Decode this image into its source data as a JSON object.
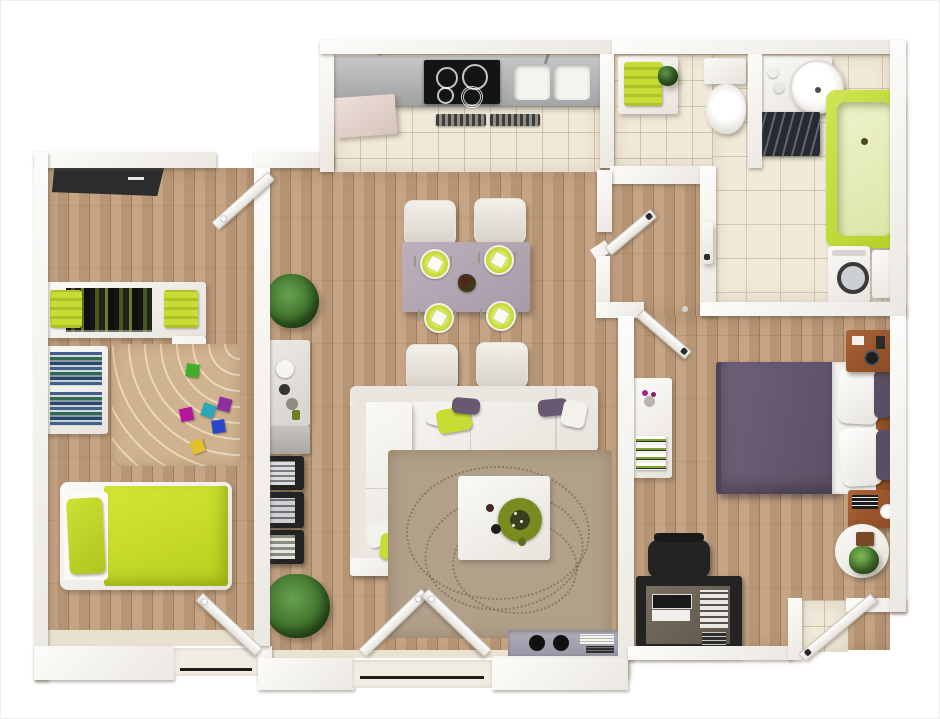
{
  "scene": {
    "type": "3d-floor-plan-top-view",
    "subject": "two-bedroom apartment rendered from above with lime green and purple accents",
    "background": "#ffffff"
  },
  "palette": {
    "wall": "#f7f5f2",
    "wall_shade": "#d8d2c9",
    "wood": "#c19e7c",
    "wood_line": "#a07c57",
    "tile": "#f0e9d9",
    "tile_line": "#cbbda0",
    "lime": "#c6dd33",
    "lime_dark": "#a9c11c",
    "lime_pale": "#e9efc0",
    "purple": "#685970",
    "purple_dark": "#564b60",
    "mauve": "#b3a6b3",
    "taupe_rug": "#b2a08a",
    "beige_rug": "#cfb28e",
    "dark": "#232323",
    "steel": "#b7b9bb",
    "wood_brown": "#9a5830",
    "plant": "#3c7329",
    "white_f": "#f6f4f0"
  },
  "rooms": [
    {
      "id": "kitchen",
      "label": "kitchen",
      "items": [
        "fridge",
        "steel-counter",
        "black-cooktop",
        "double-sink",
        "vent-grille",
        "tile-floor"
      ]
    },
    {
      "id": "wc",
      "label": "toilet room",
      "items": [
        "towel-cabinet",
        "lime-towel",
        "small-plant",
        "toilet"
      ]
    },
    {
      "id": "bathroom",
      "label": "bathroom",
      "items": [
        "vanity",
        "round-basin",
        "zebra-mat",
        "lime-bathtub",
        "washing-machine",
        "side-cabinet"
      ]
    },
    {
      "id": "bedroom-2",
      "label": "bedroom 2",
      "items": [
        "dark-entry-mat",
        "entry-door",
        "wardrobe",
        "lime-baskets",
        "bookshelf",
        "arc-rug",
        "toy-cubes",
        "lime-single-bed",
        "balcony-door"
      ]
    },
    {
      "id": "living-dining",
      "label": "living and dining room",
      "items": [
        "dining-table",
        "four-chairs",
        "lime-plates",
        "centerpiece",
        "sideboard",
        "magazine-rack",
        "potted-plants",
        "l-shaped-sofa",
        "throw-pillows",
        "swirl-rug",
        "coffee-table",
        "decor-bowl",
        "media-console",
        "speakers",
        "french-balcony-doors"
      ]
    },
    {
      "id": "hallway",
      "label": "hallway",
      "items": [
        "wc-door",
        "bathroom-door",
        "master-door"
      ]
    },
    {
      "id": "master-bedroom",
      "label": "master bedroom",
      "items": [
        "purple-double-bed",
        "white-pillows",
        "wood-headboard",
        "nightstand-top",
        "nightstand-bottom",
        "console-table",
        "flower-vase",
        "striped-books",
        "black-desk",
        "laptop",
        "desk-chair",
        "round-side-table",
        "plant",
        "exit-door"
      ]
    }
  ]
}
